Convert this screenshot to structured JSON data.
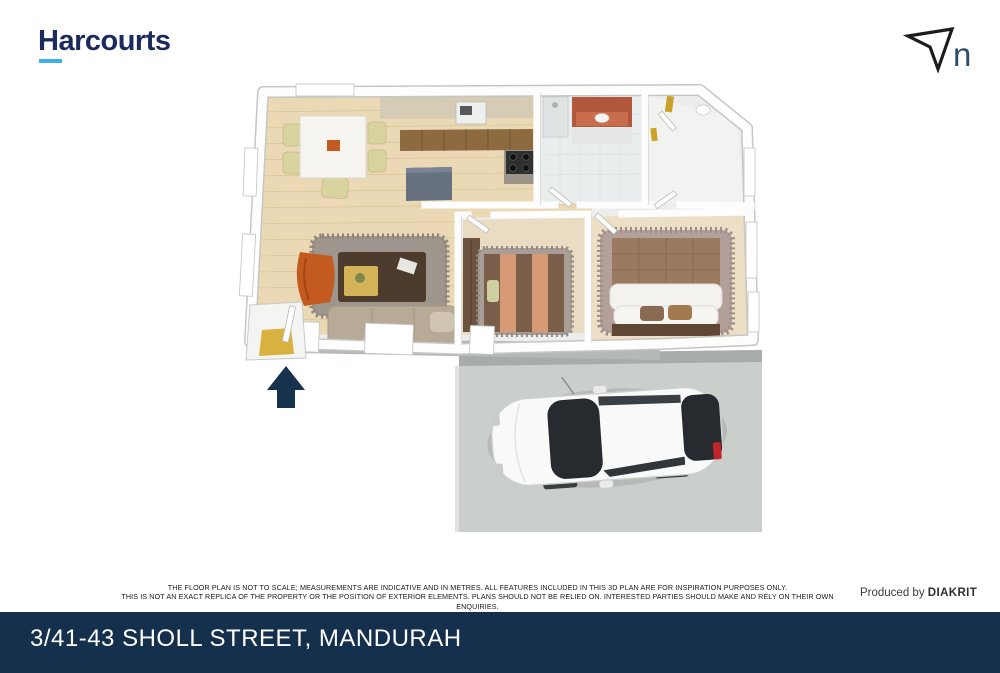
{
  "branding": {
    "logo_text": "Harcourts",
    "logo_color": "#1b2b5c",
    "accent_underline_color": "#3fb0e8"
  },
  "compass": {
    "label": "n",
    "arrow_style": "outlined navigation arrow pointing up-right"
  },
  "floorplan": {
    "type": "3d-top-down-floorplan",
    "rooms": [
      "dining-area",
      "kitchen",
      "bathroom",
      "laundry-wc",
      "living-room",
      "bedroom-2",
      "master-bedroom",
      "entry-porch",
      "driveway"
    ],
    "entrance_arrow_color": "#16324d",
    "driveway_color": "#cbcfcc",
    "car_color": "#f8f9f8",
    "floor_wood_color": "#ead9b4",
    "carpet_color": "#e9dcc2"
  },
  "disclaimer": {
    "line1": "THE FLOOR PLAN IS NOT TO SCALE; MEASUREMENTS ARE INDICATIVE AND IN METRES. ALL FEATURES INCLUDED IN THIS 3D PLAN ARE FOR INSPIRATION PURPOSES ONLY.",
    "line2": "THIS IS NOT AN EXACT REPLICA OF THE PROPERTY OR THE POSITION OF EXTERIOR ELEMENTS. PLANS SHOULD NOT BE RELIED ON. INTERESTED PARTIES SHOULD MAKE AND RELY ON THEIR OWN ENQUIRIES."
  },
  "credit": {
    "prefix": "Produced by ",
    "brand": "DIAKRIT"
  },
  "footer": {
    "address": "3/41-43 SHOLL STREET, MANDURAH",
    "background": "#14304d",
    "text_color": "#ffffff"
  }
}
